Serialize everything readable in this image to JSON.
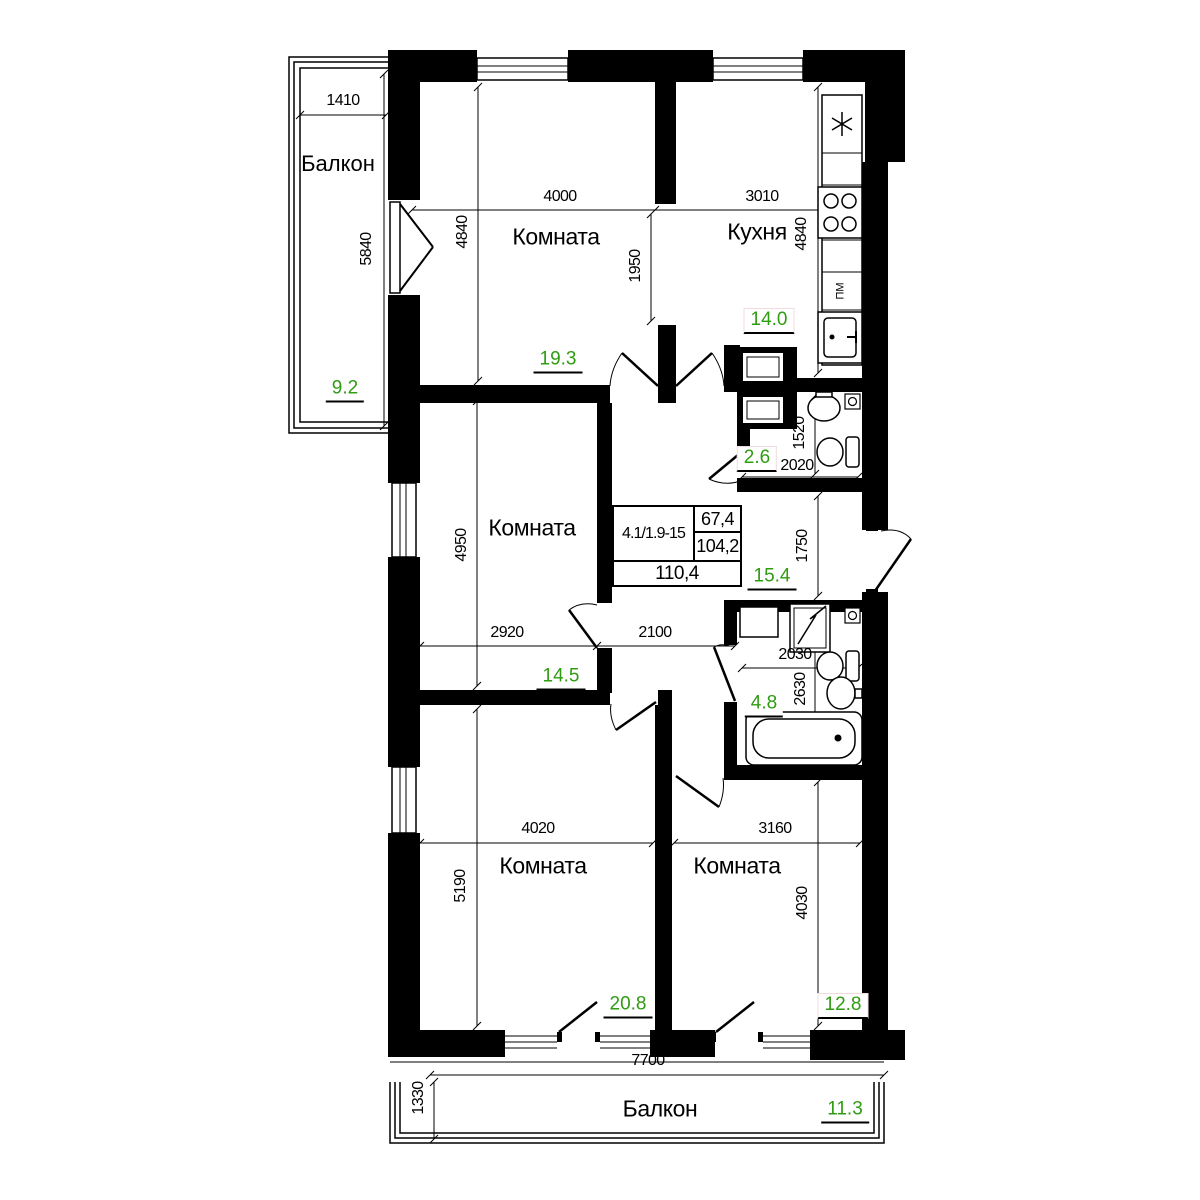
{
  "colors": {
    "area_value": "#2f9c12",
    "walls": "#000000"
  },
  "info_table": {
    "apartment_code": "4.1/1.9-15",
    "living_area": "67,4",
    "total_area": "104,2",
    "overall_area": "110,4"
  },
  "rooms": {
    "balcony_top": {
      "label": "Балкон",
      "area": "9.2"
    },
    "room_top": {
      "label": "Комната",
      "area": "19.3"
    },
    "kitchen": {
      "label": "Кухня",
      "area": "14.0",
      "dishwasher_label": "ПМ"
    },
    "wc": {
      "area": "2.6"
    },
    "hall": {
      "area": "15.4"
    },
    "room_middle": {
      "label": "Комната",
      "area": "14.5"
    },
    "bathroom": {
      "area": "4.8"
    },
    "room_bottom_left": {
      "label": "Комната",
      "area": "20.8"
    },
    "room_bottom_right": {
      "label": "Комната",
      "area": "12.8"
    },
    "balcony_bottom": {
      "label": "Балкон",
      "area": "11.3"
    }
  },
  "dimensions_mm": {
    "balcony_top_width": "1410",
    "balcony_top_depth": "5840",
    "room_top_width": "4000",
    "room_top_depth": "4840",
    "room_top_opening": "1950",
    "kitchen_width": "3010",
    "kitchen_depth": "4840",
    "wc_depth": "1520",
    "wc_width": "2020",
    "hall_depth": "1750",
    "hall_width": "2100",
    "room_middle_depth": "4950",
    "room_middle_width": "2920",
    "bathroom_width": "2030",
    "bathroom_depth": "2630",
    "room_bottom_left_width": "4020",
    "room_bottom_left_depth": "5190",
    "room_bottom_right_width": "3160",
    "room_bottom_right_depth": "4030",
    "balcony_bottom_width": "7700",
    "balcony_bottom_depth": "1330"
  }
}
